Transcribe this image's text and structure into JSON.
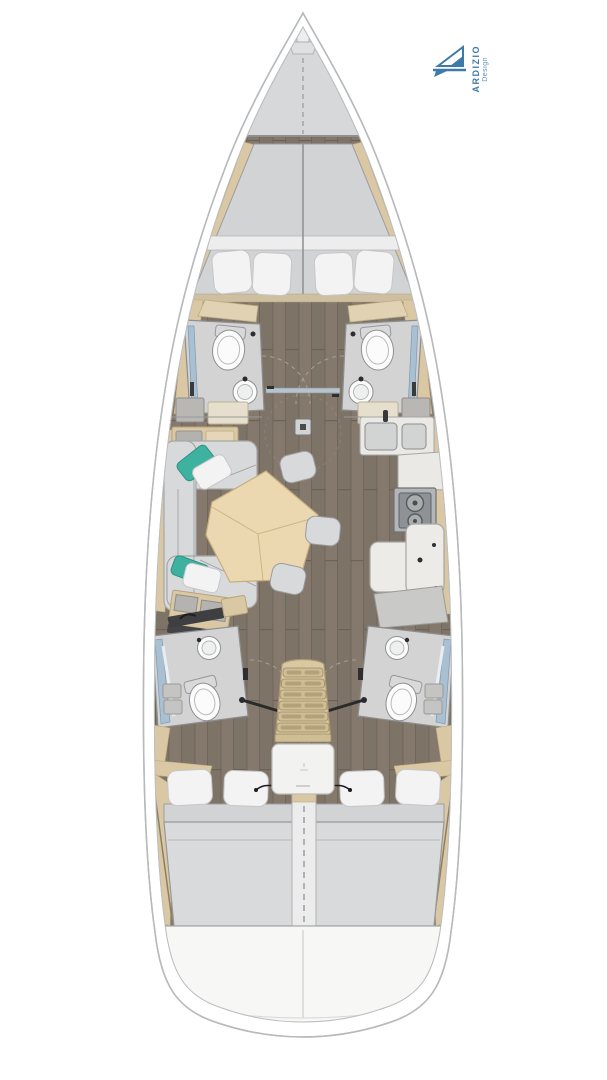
{
  "logo": {
    "brand": "ARDIZIO",
    "subtitle": "Design",
    "icon": "sailboat-logo-icon",
    "color": "#3d7aa9",
    "subtitle_color": "#5b93bb"
  },
  "palette": {
    "page_bg": "#ffffff",
    "hull_stroke": "#b7babc",
    "deck": "#d7d8d9",
    "wood_floor": "#83796d",
    "trim_tan": "#d9c8a3",
    "mattress": "#d9dadc",
    "pillow_white": "#f3f3f4",
    "pillow_teal": "#3fb1a0",
    "table_wood": "#ecd8b0",
    "seat_gray": "#d8d9da",
    "bath_floor": "#d3d3d4",
    "fixture_white": "#fbfbfb",
    "stove_gray": "#8e9296",
    "shower_blue": "#a9bfd2",
    "stairs_tan": "#d9c8a2",
    "logo_color": "#3d7aa9",
    "logo_subtitle_color": "#5b93bb"
  }
}
